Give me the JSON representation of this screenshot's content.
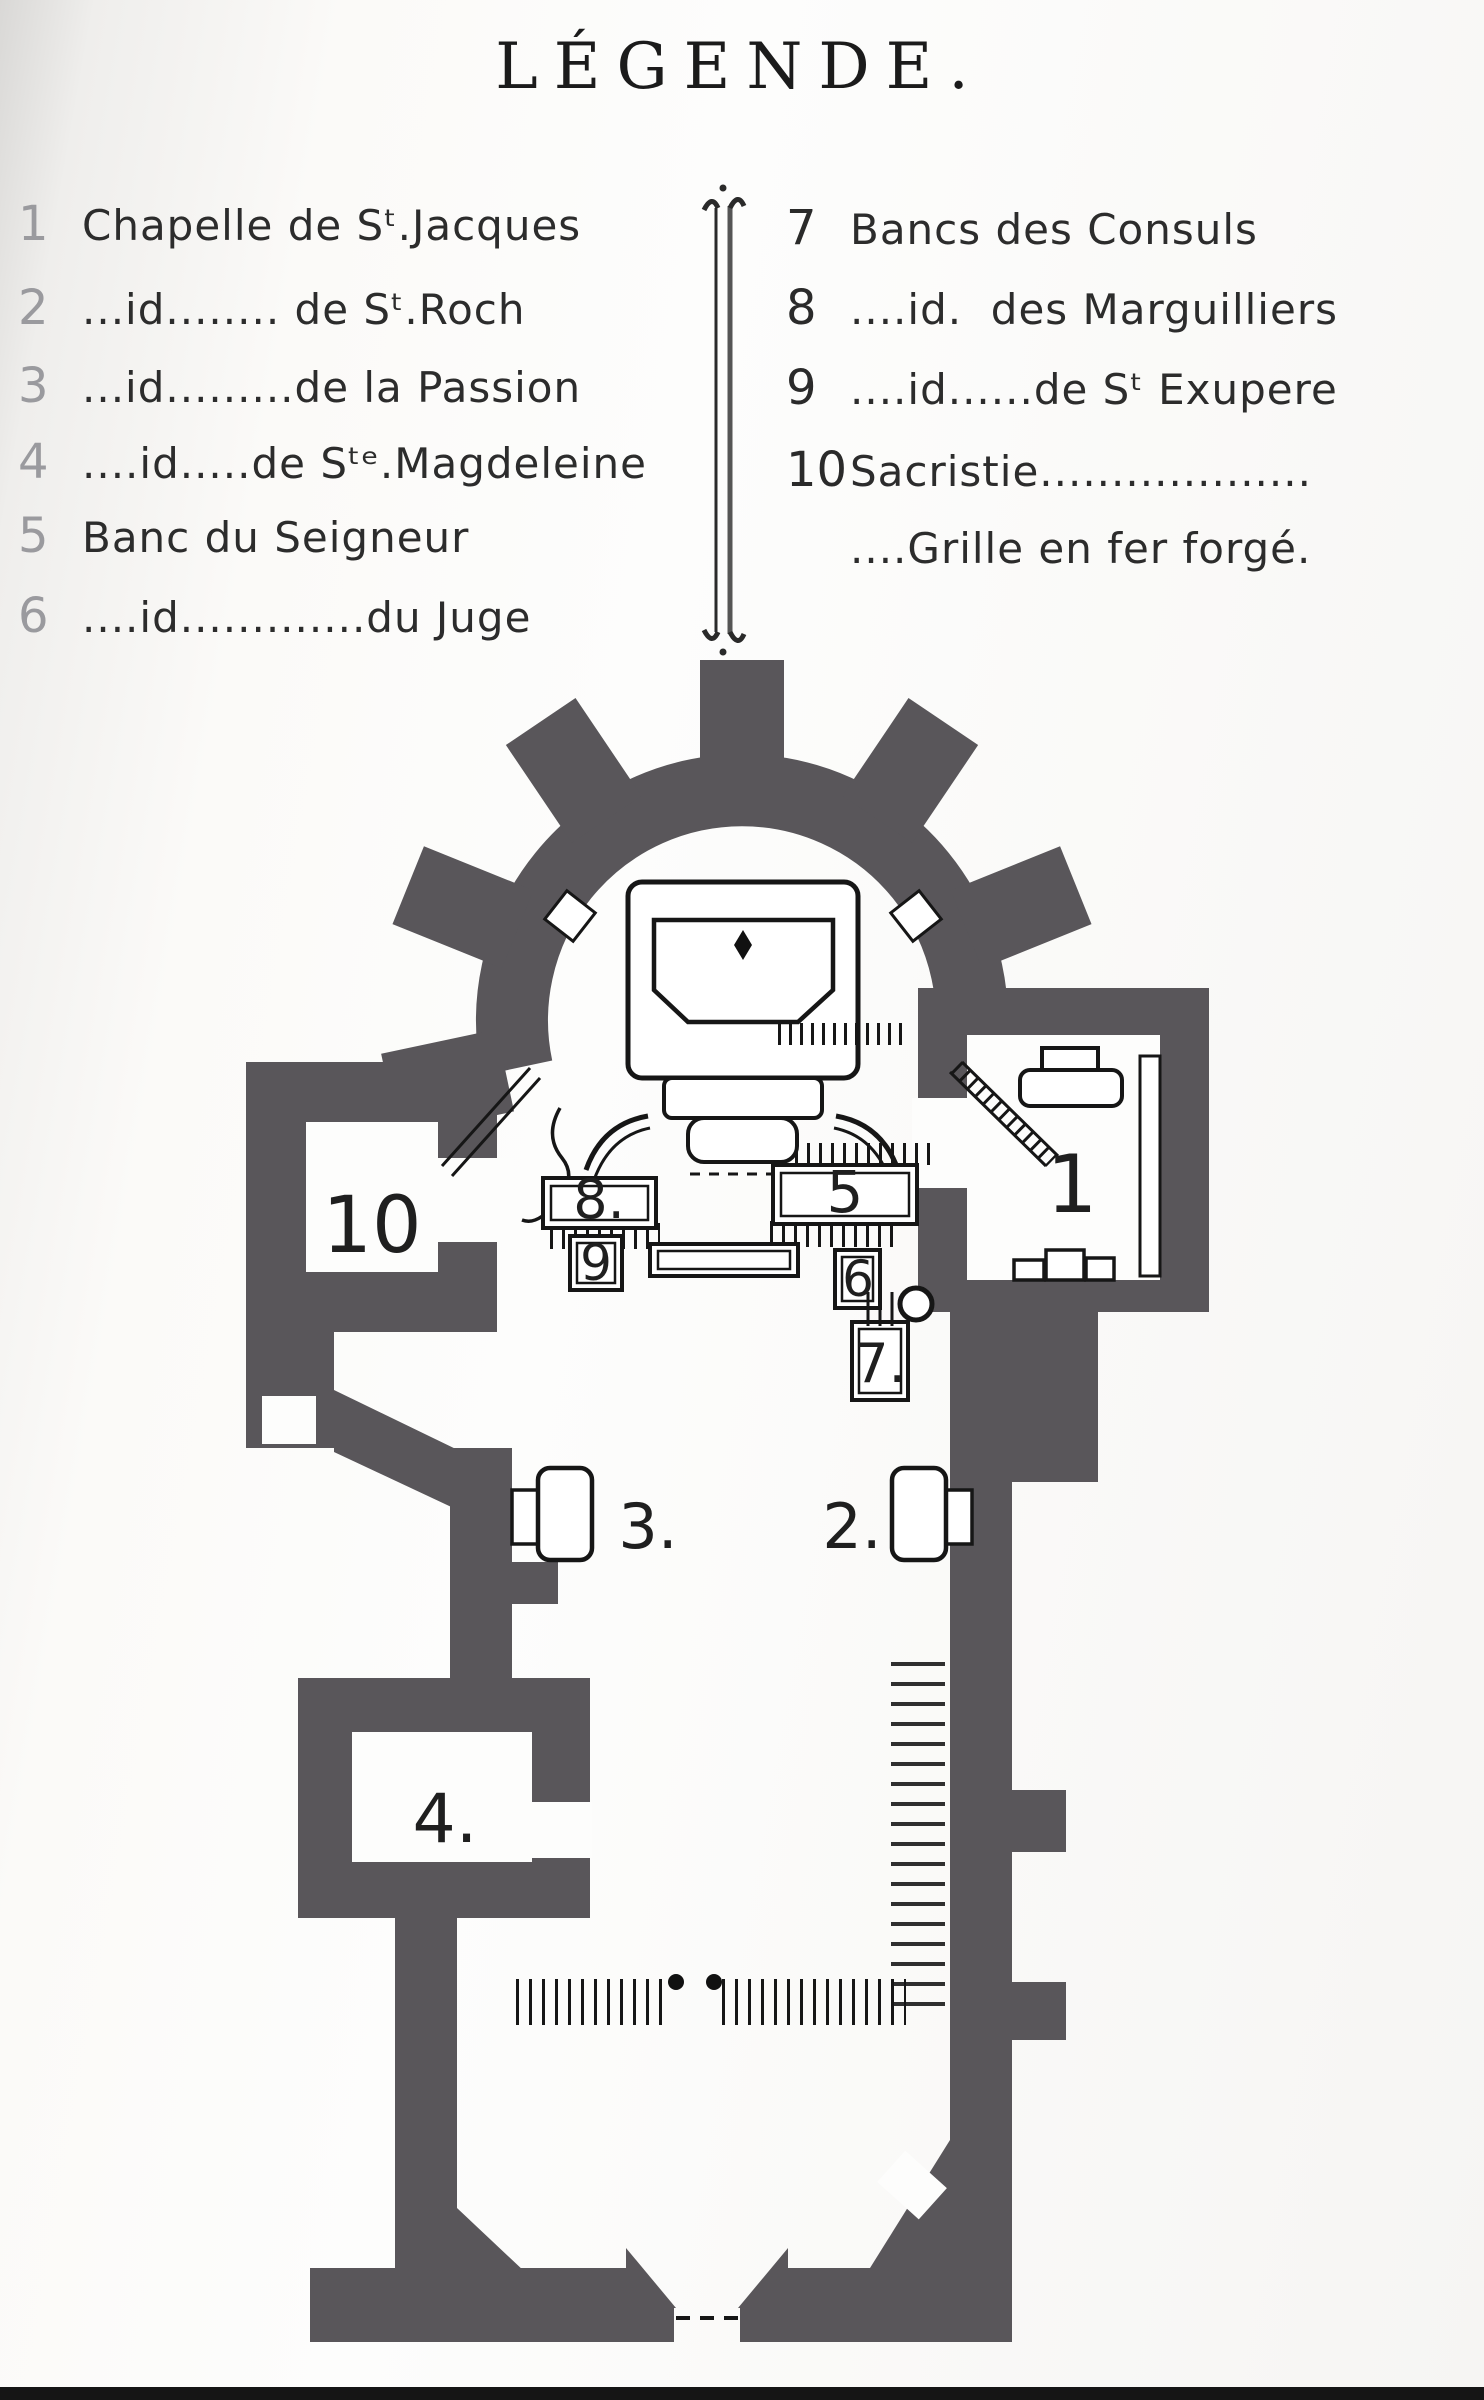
{
  "page": {
    "title": "LÉGENDE."
  },
  "colors": {
    "wall": "#59565a",
    "ink": "#161616",
    "label": "#1f1f1f"
  },
  "legend": {
    "left": [
      {
        "num": "1",
        "text": "Chapelle de Sᵗ.Jacques"
      },
      {
        "num": "2",
        "text": "...id........ de Sᵗ.Roch"
      },
      {
        "num": "3",
        "text": "...id.........de la Passion"
      },
      {
        "num": "4",
        "text": "....id.....de Sᵗᵉ.Magdeleine"
      },
      {
        "num": "5",
        "text": "Banc du Seigneur"
      },
      {
        "num": "6",
        "text": "....id.............du Juge"
      }
    ],
    "right": [
      {
        "num": "7",
        "text": "Bancs des Consuls"
      },
      {
        "num": "8",
        "text": "....id.  des Marguilliers"
      },
      {
        "num": "9",
        "text": "....id......de Sᵗ Exupere"
      },
      {
        "num": "10",
        "text": "Sacristie..................."
      },
      {
        "num": "",
        "text": "....Grille en fer forgé."
      }
    ]
  },
  "plan": {
    "labels": [
      {
        "id": "room-10",
        "text": "10"
      },
      {
        "id": "chapel-1",
        "text": "1"
      },
      {
        "id": "bench-8",
        "text": "8."
      },
      {
        "id": "bench-5",
        "text": "5"
      },
      {
        "id": "bench-9",
        "text": "9"
      },
      {
        "id": "bench-6",
        "text": "6"
      },
      {
        "id": "bench-7",
        "text": "7."
      },
      {
        "id": "altar-3",
        "text": "3."
      },
      {
        "id": "altar-2",
        "text": "2."
      },
      {
        "id": "chapel-4",
        "text": "4."
      }
    ]
  }
}
